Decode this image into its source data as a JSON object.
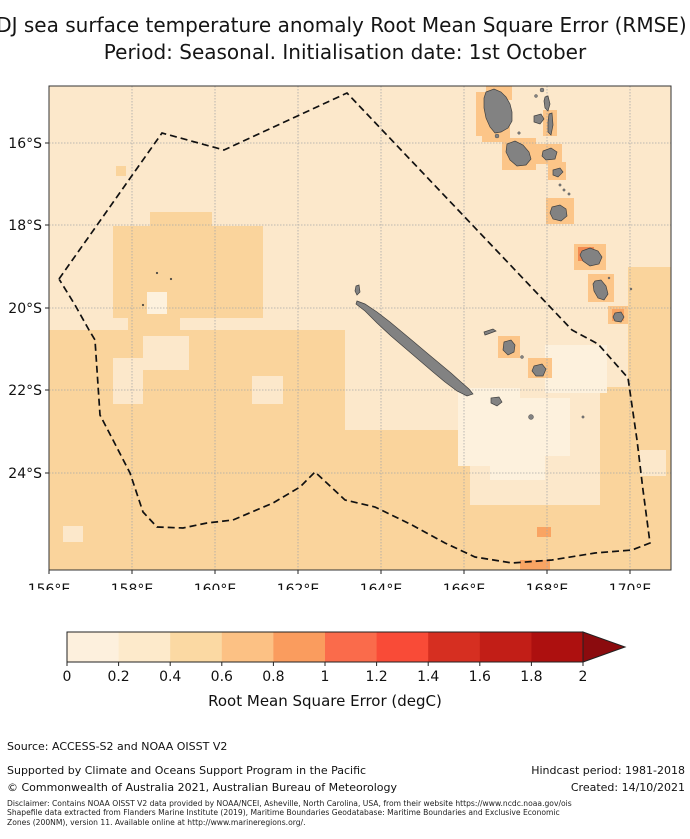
{
  "title": {
    "line1": "NDJ sea surface temperature anomaly Root Mean Square Error (RMSE)",
    "line2": "Period: Seasonal. Initialisation date: 1st October"
  },
  "chart_data": {
    "type": "heatmap",
    "title": "NDJ sea surface temperature anomaly Root Mean Square Error (RMSE)",
    "subtitle": "Period: Seasonal. Initialisation date: 1st October",
    "xlabel": "Longitude",
    "ylabel": "Latitude",
    "x_ticks": [
      "156°E",
      "158°E",
      "160°E",
      "162°E",
      "164°E",
      "166°E",
      "168°E",
      "170°E"
    ],
    "y_ticks": [
      "16°S",
      "18°S",
      "20°S",
      "22°S",
      "24°S"
    ],
    "lon_range": [
      156,
      171
    ],
    "lat_range": [
      -26.3,
      -14.6
    ],
    "value_scale": {
      "label": "Root Mean Square Error (degC)",
      "min": 0,
      "max": 2,
      "step": 0.2,
      "extend": "max"
    },
    "summary": "Most ocean grid cells 0.2-0.4 degC RMSE; patches 0.4-0.6 in southwest and east; 0-0.2 cells south/east of New Caledonia; 0.6-1.0 halo cells around Vanuatu islands; dashed EEZ boundary polygon; grey land: New Caledonia, Loyalty Islands, Vanuatu chain"
  },
  "map": {
    "frame": {
      "x": 49,
      "y": 86,
      "w": 622,
      "h": 484
    },
    "colors": {
      "base": "#fce8cb",
      "dark": "#fad49c",
      "cream": "#fdf1dd",
      "med": "#fcc588",
      "deep": "#f9a463",
      "hot": "#f28a51",
      "island": "#828282",
      "island_edge": "#404040",
      "grid": "#a8a8a8",
      "eez": "#111111",
      "frame": "#333333"
    },
    "x_ticks": [
      {
        "label": "156°E",
        "x": 49
      },
      {
        "label": "158°E",
        "x": 132
      },
      {
        "label": "160°E",
        "x": 215
      },
      {
        "label": "162°E",
        "x": 298
      },
      {
        "label": "164°E",
        "x": 381
      },
      {
        "label": "166°E",
        "x": 464
      },
      {
        "label": "168°E",
        "x": 547
      },
      {
        "label": "170°E",
        "x": 630
      }
    ],
    "y_ticks": [
      {
        "label": "16°S",
        "y": 143
      },
      {
        "label": "18°S",
        "y": 225
      },
      {
        "label": "20°S",
        "y": 308
      },
      {
        "label": "22°S",
        "y": 390
      },
      {
        "label": "24°S",
        "y": 473
      }
    ],
    "patches": [
      {
        "k": "dark",
        "r": [
          116,
          166,
          10,
          10
        ]
      },
      {
        "k": "dark",
        "r": [
          150,
          212,
          62,
          18
        ]
      },
      {
        "k": "dark",
        "r": [
          113,
          226,
          150,
          92
        ]
      },
      {
        "k": "dark",
        "r": [
          128,
          310,
          52,
          24
        ]
      },
      {
        "k": "dark",
        "r": [
          49,
          330,
          296,
          240
        ]
      },
      {
        "k": "dark",
        "r": [
          345,
          430,
          125,
          140
        ]
      },
      {
        "k": "dark",
        "r": [
          440,
          505,
          170,
          65
        ]
      },
      {
        "k": "dark",
        "r": [
          628,
          267,
          43,
          120
        ]
      },
      {
        "k": "dark",
        "r": [
          600,
          387,
          71,
          183
        ]
      },
      {
        "k": "base",
        "r": [
          143,
          336,
          46,
          34
        ]
      },
      {
        "k": "base",
        "r": [
          113,
          358,
          30,
          46
        ]
      },
      {
        "k": "base",
        "r": [
          252,
          376,
          31,
          28
        ]
      },
      {
        "k": "base",
        "r": [
          63,
          526,
          20,
          16
        ]
      },
      {
        "k": "base",
        "r": [
          640,
          450,
          26,
          26
        ]
      },
      {
        "k": "cream",
        "r": [
          458,
          388,
          62,
          78
        ]
      },
      {
        "k": "cream",
        "r": [
          512,
          398,
          58,
          58
        ]
      },
      {
        "k": "cream",
        "r": [
          545,
          345,
          62,
          48
        ]
      },
      {
        "k": "cream",
        "r": [
          490,
          440,
          55,
          40
        ]
      },
      {
        "k": "cream",
        "r": [
          147,
          292,
          20,
          22
        ]
      },
      {
        "k": "med",
        "r": [
          486,
          86,
          26,
          14
        ]
      },
      {
        "k": "med",
        "r": [
          476,
          92,
          16,
          44
        ]
      },
      {
        "k": "med",
        "r": [
          482,
          120,
          28,
          22
        ]
      },
      {
        "k": "med",
        "r": [
          502,
          138,
          34,
          32
        ]
      },
      {
        "k": "med",
        "r": [
          543,
          110,
          14,
          26
        ]
      },
      {
        "k": "med",
        "r": [
          536,
          144,
          26,
          20
        ]
      },
      {
        "k": "med",
        "r": [
          548,
          162,
          18,
          18
        ]
      },
      {
        "k": "med",
        "r": [
          546,
          198,
          28,
          26
        ]
      },
      {
        "k": "med",
        "r": [
          574,
          244,
          32,
          26
        ]
      },
      {
        "k": "med",
        "r": [
          588,
          274,
          26,
          28
        ]
      },
      {
        "k": "med",
        "r": [
          608,
          306,
          20,
          18
        ]
      },
      {
        "k": "med",
        "r": [
          498,
          336,
          22,
          22
        ]
      },
      {
        "k": "med",
        "r": [
          528,
          358,
          24,
          20
        ]
      },
      {
        "k": "deep",
        "r": [
          537,
          527,
          14,
          10
        ]
      },
      {
        "k": "deep",
        "r": [
          520,
          560,
          30,
          10
        ]
      },
      {
        "k": "deep",
        "r": [
          612,
          309,
          12,
          12
        ]
      },
      {
        "k": "hot",
        "r": [
          578,
          247,
          16,
          14
        ]
      }
    ],
    "eez_boundary": [
      [
        59,
        279
      ],
      [
        162,
        133
      ],
      [
        224,
        150
      ],
      [
        347,
        93
      ],
      [
        572,
        330
      ],
      [
        598,
        344
      ],
      [
        628,
        378
      ],
      [
        637,
        440
      ],
      [
        643,
        490
      ],
      [
        650,
        543
      ],
      [
        632,
        550
      ],
      [
        595,
        553
      ],
      [
        552,
        560
      ],
      [
        512,
        563
      ],
      [
        475,
        557
      ],
      [
        445,
        543
      ],
      [
        412,
        525
      ],
      [
        375,
        507
      ],
      [
        345,
        500
      ],
      [
        315,
        472
      ],
      [
        300,
        487
      ],
      [
        273,
        503
      ],
      [
        233,
        520
      ],
      [
        207,
        523
      ],
      [
        183,
        528
      ],
      [
        157,
        527
      ],
      [
        143,
        512
      ],
      [
        130,
        473
      ],
      [
        113,
        440
      ],
      [
        100,
        415
      ],
      [
        95,
        340
      ],
      [
        89,
        330
      ],
      [
        75,
        305
      ],
      [
        59,
        279
      ]
    ],
    "islands": [
      {
        "name": "grande-terre",
        "pts": [
          [
            357,
            301
          ],
          [
            365,
            304
          ],
          [
            377,
            312
          ],
          [
            390,
            322
          ],
          [
            402,
            332
          ],
          [
            414,
            342
          ],
          [
            427,
            353
          ],
          [
            439,
            363
          ],
          [
            451,
            373
          ],
          [
            461,
            382
          ],
          [
            469,
            389
          ],
          [
            473,
            394
          ],
          [
            467,
            396
          ],
          [
            457,
            391
          ],
          [
            445,
            382
          ],
          [
            433,
            372
          ],
          [
            419,
            360
          ],
          [
            405,
            348
          ],
          [
            391,
            336
          ],
          [
            377,
            323
          ],
          [
            365,
            311
          ],
          [
            356,
            304
          ]
        ]
      },
      {
        "name": "isle-of-pines",
        "pts": [
          [
            491,
            398
          ],
          [
            499,
            397
          ],
          [
            502,
            402
          ],
          [
            497,
            406
          ],
          [
            491,
            403
          ]
        ]
      },
      {
        "name": "belep",
        "pts": [
          [
            356,
            286
          ],
          [
            359,
            285
          ],
          [
            360,
            292
          ],
          [
            357,
            295
          ],
          [
            355,
            291
          ]
        ]
      },
      {
        "name": "ouvea",
        "pts": [
          [
            484,
            332
          ],
          [
            493,
            329
          ],
          [
            496,
            331
          ],
          [
            488,
            334
          ],
          [
            485,
            335
          ]
        ]
      },
      {
        "name": "lifou",
        "pts": [
          [
            504,
            342
          ],
          [
            511,
            340
          ],
          [
            515,
            345
          ],
          [
            514,
            352
          ],
          [
            508,
            355
          ],
          [
            503,
            350
          ]
        ]
      },
      {
        "name": "mare",
        "pts": [
          [
            534,
            366
          ],
          [
            542,
            364
          ],
          [
            546,
            369
          ],
          [
            543,
            376
          ],
          [
            536,
            376
          ],
          [
            532,
            371
          ]
        ]
      },
      {
        "name": "espiritu-santo",
        "pts": [
          [
            486,
            92
          ],
          [
            494,
            89
          ],
          [
            501,
            92
          ],
          [
            506,
            97
          ],
          [
            510,
            104
          ],
          [
            512,
            112
          ],
          [
            512,
            121
          ],
          [
            508,
            128
          ],
          [
            501,
            132
          ],
          [
            495,
            133
          ],
          [
            490,
            127
          ],
          [
            486,
            118
          ],
          [
            484,
            108
          ],
          [
            484,
            98
          ]
        ]
      },
      {
        "name": "malakula",
        "pts": [
          [
            507,
            144
          ],
          [
            515,
            141
          ],
          [
            523,
            145
          ],
          [
            529,
            152
          ],
          [
            531,
            159
          ],
          [
            526,
            165
          ],
          [
            517,
            166
          ],
          [
            510,
            160
          ],
          [
            506,
            152
          ]
        ]
      },
      {
        "name": "pentecost",
        "pts": [
          [
            549,
            114
          ],
          [
            552,
            113
          ],
          [
            553,
            125
          ],
          [
            551,
            135
          ],
          [
            548,
            132
          ],
          [
            548,
            122
          ]
        ]
      },
      {
        "name": "maewo",
        "pts": [
          [
            545,
            97
          ],
          [
            548,
            96
          ],
          [
            550,
            104
          ],
          [
            548,
            111
          ],
          [
            545,
            108
          ],
          [
            544,
            101
          ]
        ]
      },
      {
        "name": "ambae",
        "pts": [
          [
            534,
            116
          ],
          [
            541,
            114
          ],
          [
            544,
            119
          ],
          [
            540,
            124
          ],
          [
            534,
            122
          ]
        ]
      },
      {
        "name": "ambrym",
        "pts": [
          [
            543,
            151
          ],
          [
            551,
            148
          ],
          [
            557,
            152
          ],
          [
            555,
            159
          ],
          [
            546,
            160
          ],
          [
            542,
            156
          ]
        ]
      },
      {
        "name": "epi",
        "pts": [
          [
            553,
            170
          ],
          [
            560,
            168
          ],
          [
            563,
            172
          ],
          [
            558,
            177
          ],
          [
            553,
            175
          ]
        ]
      },
      {
        "name": "efate",
        "pts": [
          [
            552,
            207
          ],
          [
            560,
            205
          ],
          [
            566,
            209
          ],
          [
            567,
            216
          ],
          [
            561,
            221
          ],
          [
            553,
            219
          ],
          [
            550,
            213
          ]
        ]
      },
      {
        "name": "erromango",
        "pts": [
          [
            582,
            251
          ],
          [
            590,
            248
          ],
          [
            598,
            251
          ],
          [
            602,
            257
          ],
          [
            599,
            264
          ],
          [
            590,
            266
          ],
          [
            583,
            261
          ],
          [
            580,
            255
          ]
        ]
      },
      {
        "name": "tanna",
        "pts": [
          [
            595,
            281
          ],
          [
            601,
            280
          ],
          [
            606,
            286
          ],
          [
            608,
            294
          ],
          [
            604,
            300
          ],
          [
            598,
            298
          ],
          [
            594,
            291
          ],
          [
            593,
            284
          ]
        ]
      },
      {
        "name": "aneityum",
        "pts": [
          [
            615,
            313
          ],
          [
            621,
            312
          ],
          [
            624,
            317
          ],
          [
            621,
            322
          ],
          [
            615,
            321
          ],
          [
            613,
            317
          ]
        ]
      }
    ],
    "dots": [
      {
        "c": [
          157,
          273
        ],
        "r": 0.9,
        "k": "reef"
      },
      {
        "c": [
          171,
          279
        ],
        "r": 0.9,
        "k": "reef"
      },
      {
        "c": [
          143,
          305
        ],
        "r": 0.9,
        "k": "reef"
      },
      {
        "c": [
          497,
          136
        ],
        "r": 2,
        "k": "isle"
      },
      {
        "c": [
          522,
          357
        ],
        "r": 1.5,
        "k": "isle"
      },
      {
        "c": [
          531,
          417
        ],
        "r": 2.5,
        "k": "isle"
      },
      {
        "c": [
          583,
          417
        ],
        "r": 1.2,
        "k": "isle"
      },
      {
        "c": [
          536,
          96
        ],
        "r": 1.5,
        "k": "isle"
      },
      {
        "c": [
          542,
          90
        ],
        "r": 2,
        "k": "isle"
      },
      {
        "c": [
          560,
          185
        ],
        "r": 1.2,
        "k": "isle"
      },
      {
        "c": [
          564,
          190
        ],
        "r": 1.2,
        "k": "isle"
      },
      {
        "c": [
          569,
          194
        ],
        "r": 1.2,
        "k": "isle"
      },
      {
        "c": [
          609,
          278
        ],
        "r": 1,
        "k": "isle"
      },
      {
        "c": [
          631,
          289
        ],
        "r": 1,
        "k": "isle"
      },
      {
        "c": [
          519,
          133
        ],
        "r": 1.3,
        "k": "isle"
      }
    ]
  },
  "colorbar": {
    "x": 67,
    "y": 632,
    "w": 516,
    "h": 30,
    "tip_x": 625,
    "segments": [
      "#fdf0dd",
      "#fdeacb",
      "#fbd9a3",
      "#fcc184",
      "#fa9c5e",
      "#fa6b4b",
      "#f94b37",
      "#d62f21",
      "#c21e17",
      "#ad100f"
    ],
    "arrow": "#8b0b0e",
    "outline": "#222222",
    "ticks": [
      "0",
      "0.2",
      "0.4",
      "0.6",
      "0.8",
      "1",
      "1.2",
      "1.4",
      "1.6",
      "1.8",
      "2"
    ],
    "label": "Root Mean Square Error (degC)"
  },
  "footer": {
    "source": "Source: ACCESS-S2 and NOAA OISST V2",
    "supported": "Supported by Climate and Oceans Support Program in the Pacific",
    "copyright": "© Commonwealth of Australia 2021, Australian Bureau of Meteorology",
    "hindcast": "Hindcast period: 1981-2018",
    "created": "Created: 14/10/2021"
  },
  "disclaimer": {
    "line1": "Disclaimer: Contains NOAA OISST V2 data provided by NOAA/NCEI, Asheville, North Carolina, USA, from their website https://www.ncdc.noaa.gov/ois",
    "line2": "Shapefile data extracted from Flanders Marine Institute (2019), Maritime Boundaries Geodatabase: Maritime Boundaries and Exclusive Economic",
    "line3": "Zones (200NM), version 11. Available online at http://www.marineregions.org/."
  }
}
